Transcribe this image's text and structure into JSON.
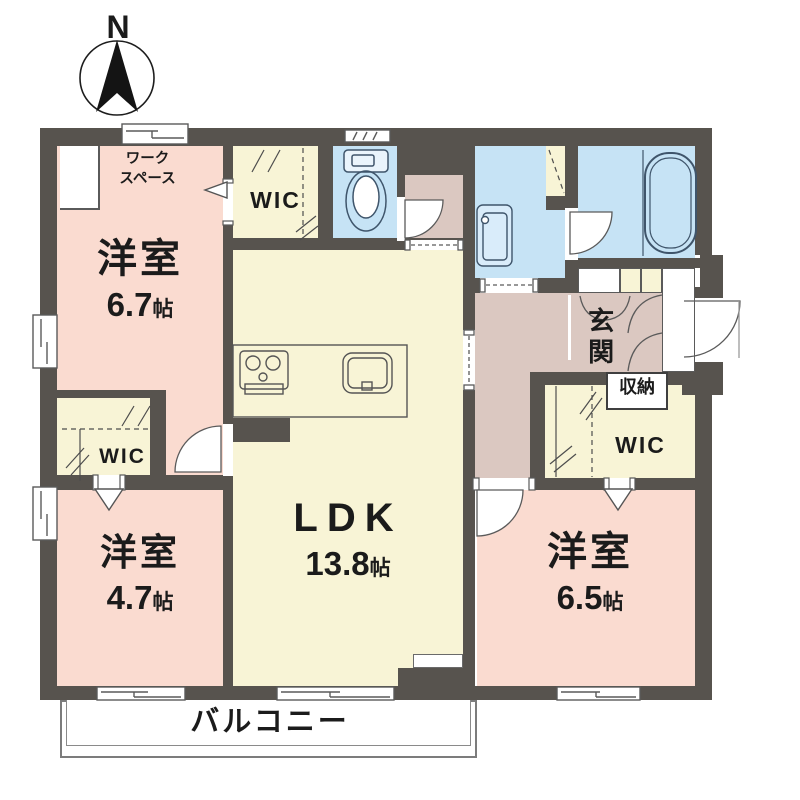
{
  "compass": {
    "label": "N"
  },
  "rooms": {
    "bedroom_nw": {
      "name": "洋室",
      "size": "6.7",
      "unit": "帖"
    },
    "bedroom_sw": {
      "name": "洋室",
      "size": "4.7",
      "unit": "帖"
    },
    "bedroom_se": {
      "name": "洋室",
      "size": "6.5",
      "unit": "帖"
    },
    "ldk": {
      "name": "LDK",
      "size": "13.8",
      "unit": "帖"
    },
    "workspace": {
      "line1": "ワーク",
      "line2": "スペース"
    },
    "wic_north": {
      "label": "WIC"
    },
    "wic_west": {
      "label": "WIC"
    },
    "wic_east": {
      "label": "WIC"
    },
    "entrance": {
      "label": "玄関"
    },
    "storage": {
      "label": "収納"
    },
    "balcony": {
      "label": "バルコニー"
    }
  },
  "colors": {
    "wall": "#57534e",
    "bedroom_floor": "#fadbd0",
    "living_floor": "#f8f4d6",
    "wet_area": "#c6e3f5",
    "hall_floor": "#dbc8c1",
    "outline": "#4d4d4d"
  }
}
